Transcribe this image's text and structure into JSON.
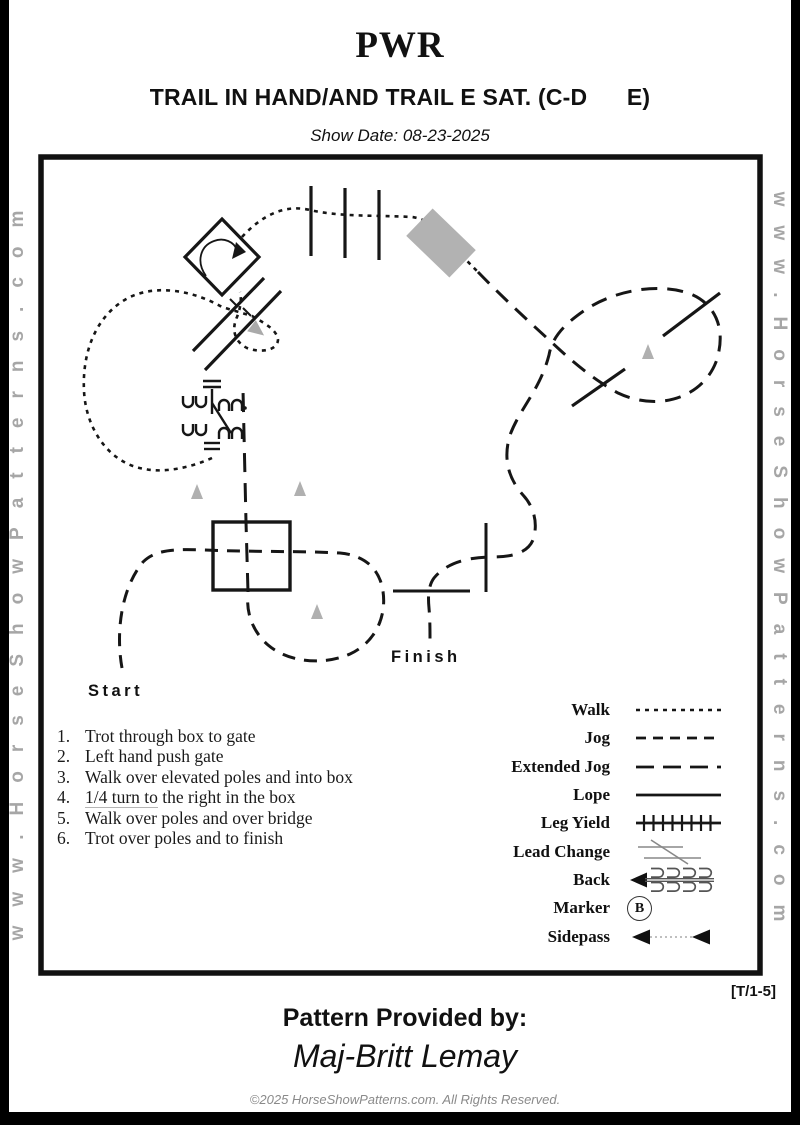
{
  "header": {
    "org": "PWR",
    "title": "TRAIL IN HAND/AND TRAIL E SAT. (C-D      E)",
    "show_date": "Show Date: 08-23-2025"
  },
  "watermark": {
    "left": "www.HorseShowPatterns.com",
    "right": "www.HorseShowPatterns.com"
  },
  "diagram": {
    "start_label": "Start",
    "finish_label": "Finish",
    "marker_letter": "B"
  },
  "instructions": {
    "items": [
      {
        "num": "1.",
        "text": "Trot through box to gate"
      },
      {
        "num": "2.",
        "text": "Left hand push gate"
      },
      {
        "num": "3.",
        "text": "Walk over elevated poles and into box"
      },
      {
        "num": "4.",
        "lead": "1/4 turn to",
        "rest": " the right in the box"
      },
      {
        "num": "5.",
        "text": "Walk over poles and over bridge"
      },
      {
        "num": "6.",
        "text": "Trot over poles and to finish"
      }
    ]
  },
  "legend": {
    "rows": [
      {
        "label": "Walk"
      },
      {
        "label": "Jog"
      },
      {
        "label": "Extended Jog"
      },
      {
        "label": "Lope"
      },
      {
        "label": "Leg Yield"
      },
      {
        "label": "Lead Change"
      },
      {
        "label": "Back"
      },
      {
        "label": "Marker"
      },
      {
        "label": "Sidepass"
      }
    ]
  },
  "footer": {
    "pattern_code": "[T/1-5]",
    "provided_by_label": "Pattern Provided by:",
    "provider_name": "Maj-Britt Lemay",
    "copyright": "©2025 HorseShowPatterns.com. All Rights Reserved."
  },
  "colors": {
    "line": "#161616",
    "cone": "#b0b0b0",
    "bridge": "#b2b2b2",
    "watermark": "#a6a6a6",
    "lead_change_gray": "#999999"
  }
}
